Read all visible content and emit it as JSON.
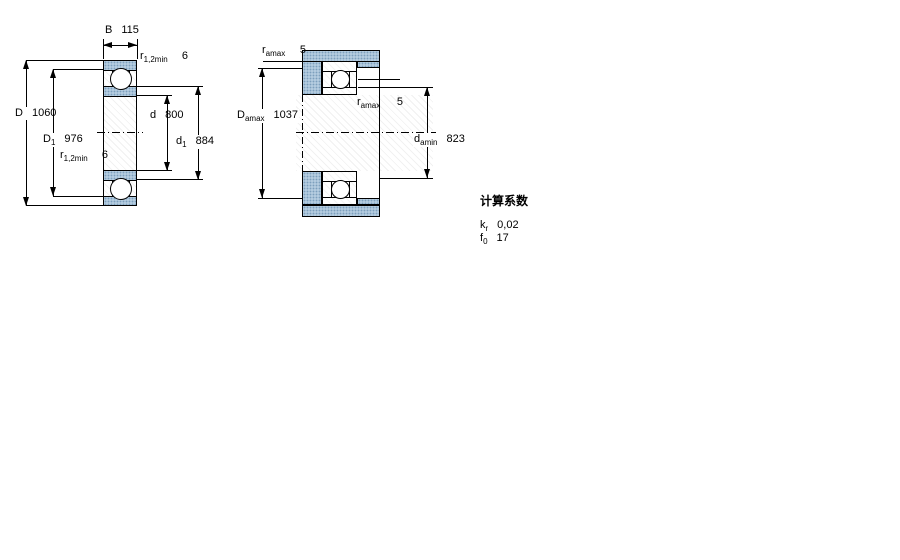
{
  "fig1": {
    "B": {
      "name": "B",
      "value": "115"
    },
    "r_top": {
      "name": "r",
      "sub": "1,2min",
      "value": "6"
    },
    "D": {
      "name": "D",
      "value": "1060"
    },
    "D1": {
      "name": "D",
      "sub": "1",
      "value": "976"
    },
    "r_bottom": {
      "name": "r",
      "sub": "1,2min",
      "value": "6"
    },
    "d": {
      "name": "d",
      "value": "800"
    },
    "d1": {
      "name": "d",
      "sub": "1",
      "value": "884"
    }
  },
  "fig2": {
    "r_a_top": {
      "name": "r",
      "sub": "amax",
      "value": "5"
    },
    "D_a": {
      "name": "D",
      "sub": "amax",
      "value": "1037"
    },
    "r_a_mid": {
      "name": "r",
      "sub": "amax",
      "value": "5"
    },
    "d_a": {
      "name": "d",
      "sub": "amin",
      "value": "823"
    }
  },
  "factors": {
    "title": "计算系数",
    "k": {
      "name": "k",
      "sub": "r",
      "value": "0,02"
    },
    "f": {
      "name": "f",
      "sub": "0",
      "value": "17"
    }
  },
  "colors": {
    "steel": "#b3cbdf",
    "steel_dot": "#7d9fbd"
  }
}
